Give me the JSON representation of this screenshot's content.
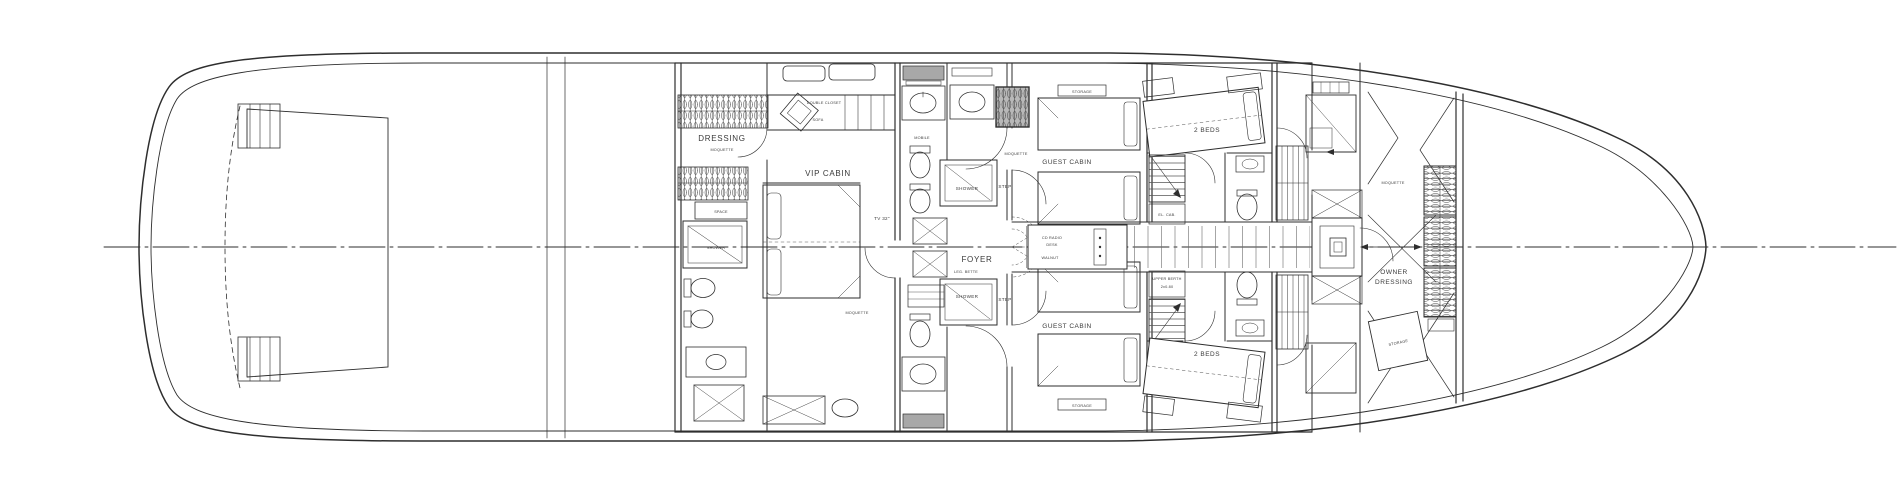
{
  "meta": {
    "drawing_type": "Yacht lower deck general arrangement floor plan",
    "orientation": "stern left, bow right"
  },
  "colors": {
    "background": "#ffffff",
    "line": "#2e2e2e",
    "text": "#3a3a3a",
    "dark_fill": "#a8a8a8"
  },
  "labels": {
    "dressing": {
      "room": "DRESSING",
      "floor": "MOQUETTE",
      "cabinet": "SPACE",
      "shower": "SHOWER"
    },
    "vip": {
      "room": "VIP CABIN",
      "tv": "TV 32\"",
      "floor": "MOQUETTE",
      "closet": "DOUBLE CLOSET",
      "sofa": "SOFA"
    },
    "bath": {
      "cabinet": "MOBILE"
    },
    "foyer": {
      "room": "FOYER",
      "floor": "LEG. BETTE",
      "landing_floor": "MOQUETTE",
      "shower_top": "SHOWER",
      "shower_bottom": "SHOWER",
      "step_top": "STEP",
      "step_bottom": "STEP"
    },
    "guest_top": {
      "room": "GUEST CABIN",
      "storage": "STORAGE"
    },
    "guest_bottom": {
      "room": "GUEST CABIN",
      "storage": "STORAGE"
    },
    "desk": {
      "line1": "CD RADIO",
      "line2": "DESK",
      "material": "WALNUT"
    },
    "twobeds_top": {
      "room": "2 BEDS",
      "cab": "EL. CAB."
    },
    "twobeds_bottom": {
      "room": "2 BEDS",
      "berth_line1": "UPPER BERTH",
      "berth_line2": "2x0.80"
    },
    "owner": {
      "room_line1": "OWNER",
      "room_line2": "DRESSING",
      "floor": "MOQUETTE",
      "storage": "STORAGE"
    }
  }
}
